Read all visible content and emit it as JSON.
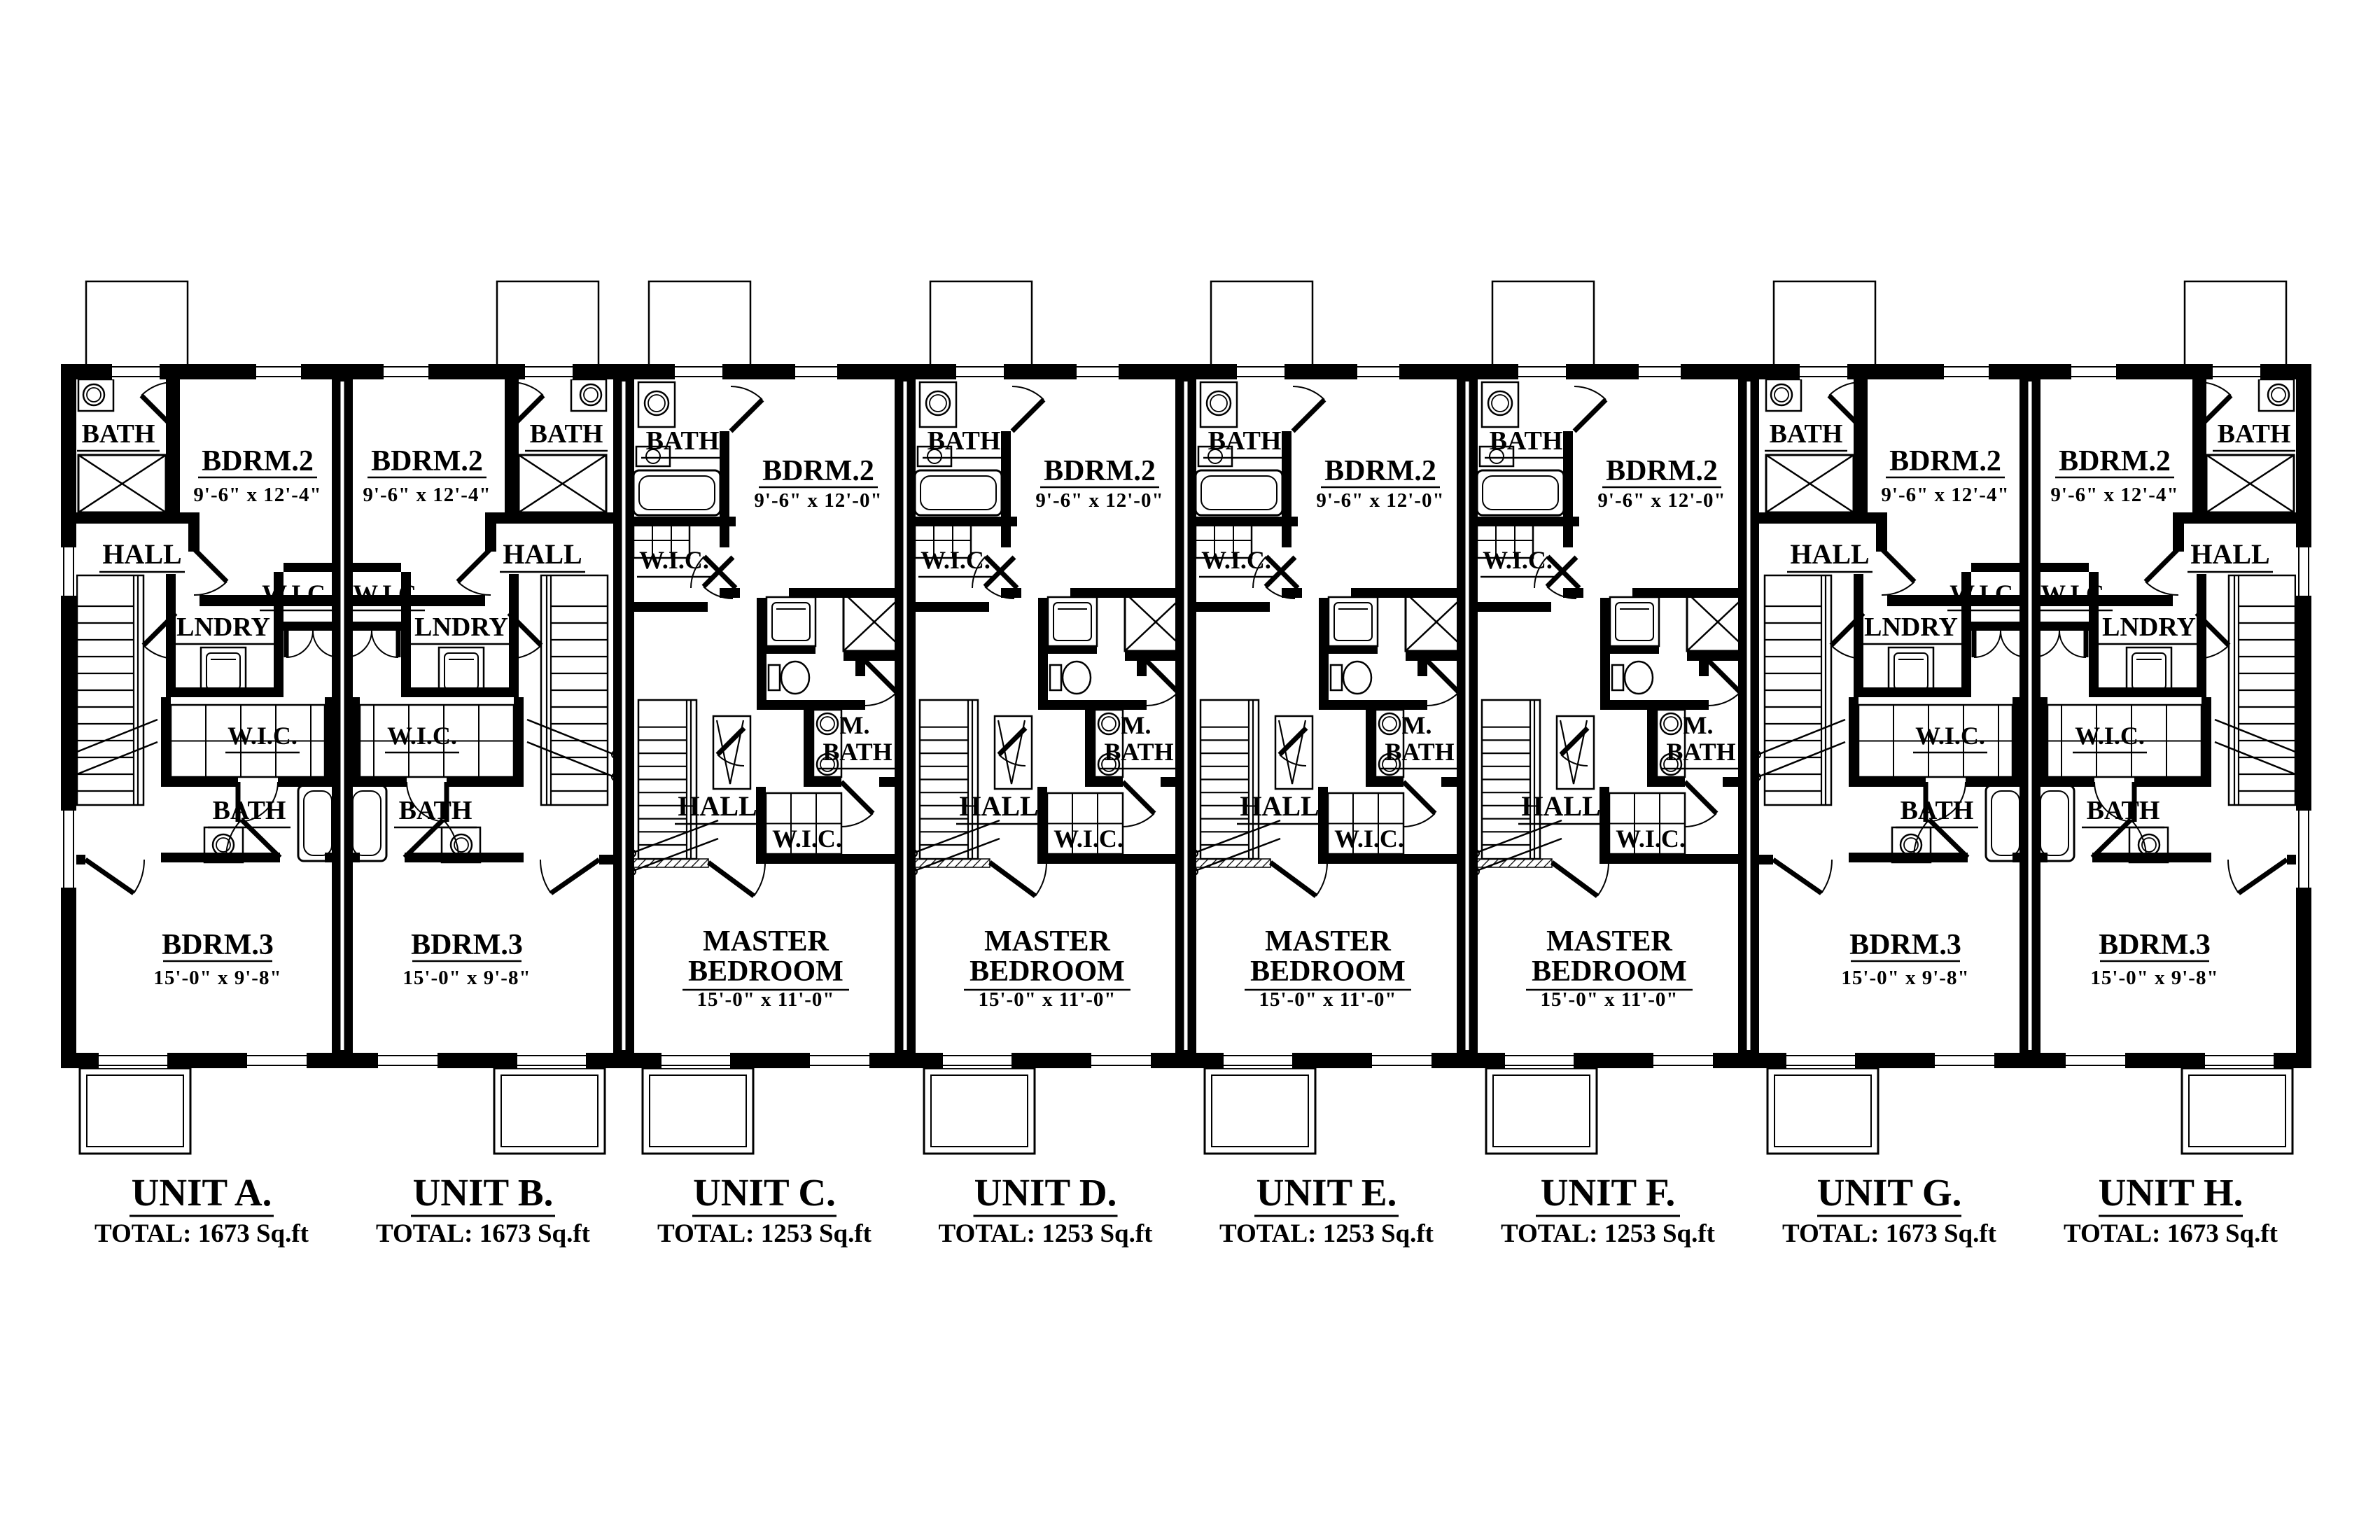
{
  "document": {
    "background": "#ffffff",
    "ink": "#000000"
  },
  "units": [
    {
      "id": "A",
      "name": "UNIT A.",
      "total": "TOTAL: 1673 Sq.ft",
      "plan": "end",
      "mirror": false,
      "rooms": {
        "bath_top": "BATH",
        "bdrm2": "BDRM.2",
        "bdrm2_dims": "9'-6\" x 12'-4\"",
        "hall": "HALL",
        "wic_side": "W.I.C.",
        "lndry": "LNDRY",
        "wic_mid": "W.I.C.",
        "bath_mid": "BATH",
        "bdrm3": "BDRM.3",
        "bdrm3_dims": "15'-0\" x 9'-8\""
      }
    },
    {
      "id": "B",
      "name": "UNIT B.",
      "total": "TOTAL: 1673 Sq.ft",
      "plan": "end",
      "mirror": true,
      "rooms": {
        "bath_top": "BATH",
        "bdrm2": "BDRM.2",
        "bdrm2_dims": "9'-6\" x 12'-4\"",
        "hall": "HALL",
        "wic_side": "W.I.C.",
        "lndry": "LNDRY",
        "wic_mid": "W.I.C.",
        "bath_mid": "BATH",
        "bdrm3": "BDRM.3",
        "bdrm3_dims": "15'-0\" x 9'-8\""
      }
    },
    {
      "id": "C",
      "name": "UNIT C.",
      "total": "TOTAL: 1253 Sq.ft",
      "plan": "mid",
      "mirror": false,
      "rooms": {
        "bath_top": "BATH",
        "bdrm2": "BDRM.2",
        "bdrm2_dims": "9'-6\" x 12'-0\"",
        "wic_up": "W.I.C.",
        "m_label": "M.",
        "m_bath": "BATH",
        "hall": "HALL",
        "wic_low": "W.I.C.",
        "master_1": "MASTER",
        "master_2": "BEDROOM",
        "master_dims": "15'-0\" x 11'-0\""
      }
    },
    {
      "id": "D",
      "name": "UNIT D.",
      "total": "TOTAL: 1253 Sq.ft",
      "plan": "mid",
      "mirror": false,
      "rooms": {
        "bath_top": "BATH",
        "bdrm2": "BDRM.2",
        "bdrm2_dims": "9'-6\" x 12'-0\"",
        "wic_up": "W.I.C.",
        "m_label": "M.",
        "m_bath": "BATH",
        "hall": "HALL",
        "wic_low": "W.I.C.",
        "master_1": "MASTER",
        "master_2": "BEDROOM",
        "master_dims": "15'-0\" x 11'-0\""
      }
    },
    {
      "id": "E",
      "name": "UNIT E.",
      "total": "TOTAL: 1253 Sq.ft",
      "plan": "mid",
      "mirror": false,
      "rooms": {
        "bath_top": "BATH",
        "bdrm2": "BDRM.2",
        "bdrm2_dims": "9'-6\" x 12'-0\"",
        "wic_up": "W.I.C.",
        "m_label": "M.",
        "m_bath": "BATH",
        "hall": "HALL",
        "wic_low": "W.I.C.",
        "master_1": "MASTER",
        "master_2": "BEDROOM",
        "master_dims": "15'-0\" x 11'-0\""
      }
    },
    {
      "id": "F",
      "name": "UNIT F.",
      "total": "TOTAL: 1253 Sq.ft",
      "plan": "mid",
      "mirror": false,
      "rooms": {
        "bath_top": "BATH",
        "bdrm2": "BDRM.2",
        "bdrm2_dims": "9'-6\" x 12'-0\"",
        "wic_up": "W.I.C.",
        "m_label": "M.",
        "m_bath": "BATH",
        "hall": "HALL",
        "wic_low": "W.I.C.",
        "master_1": "MASTER",
        "master_2": "BEDROOM",
        "master_dims": "15'-0\" x 11'-0\""
      }
    },
    {
      "id": "G",
      "name": "UNIT G.",
      "total": "TOTAL: 1673 Sq.ft",
      "plan": "end",
      "mirror": false,
      "rooms": {
        "bath_top": "BATH",
        "bdrm2": "BDRM.2",
        "bdrm2_dims": "9'-6\" x 12'-4\"",
        "hall": "HALL",
        "wic_side": "W.I.C.",
        "lndry": "LNDRY",
        "wic_mid": "W.I.C.",
        "bath_mid": "BATH",
        "bdrm3": "BDRM.3",
        "bdrm3_dims": "15'-0\" x 9'-8\""
      }
    },
    {
      "id": "H",
      "name": "UNIT H.",
      "total": "TOTAL: 1673 Sq.ft",
      "plan": "end",
      "mirror": true,
      "rooms": {
        "bath_top": "BATH",
        "bdrm2": "BDRM.2",
        "bdrm2_dims": "9'-6\" x 12'-4\"",
        "hall": "HALL",
        "wic_side": "W.I.C.",
        "lndry": "LNDRY",
        "wic_mid": "W.I.C.",
        "bath_mid": "BATH",
        "bdrm3": "BDRM.3",
        "bdrm3_dims": "15'-0\" x 9'-8\""
      }
    }
  ]
}
